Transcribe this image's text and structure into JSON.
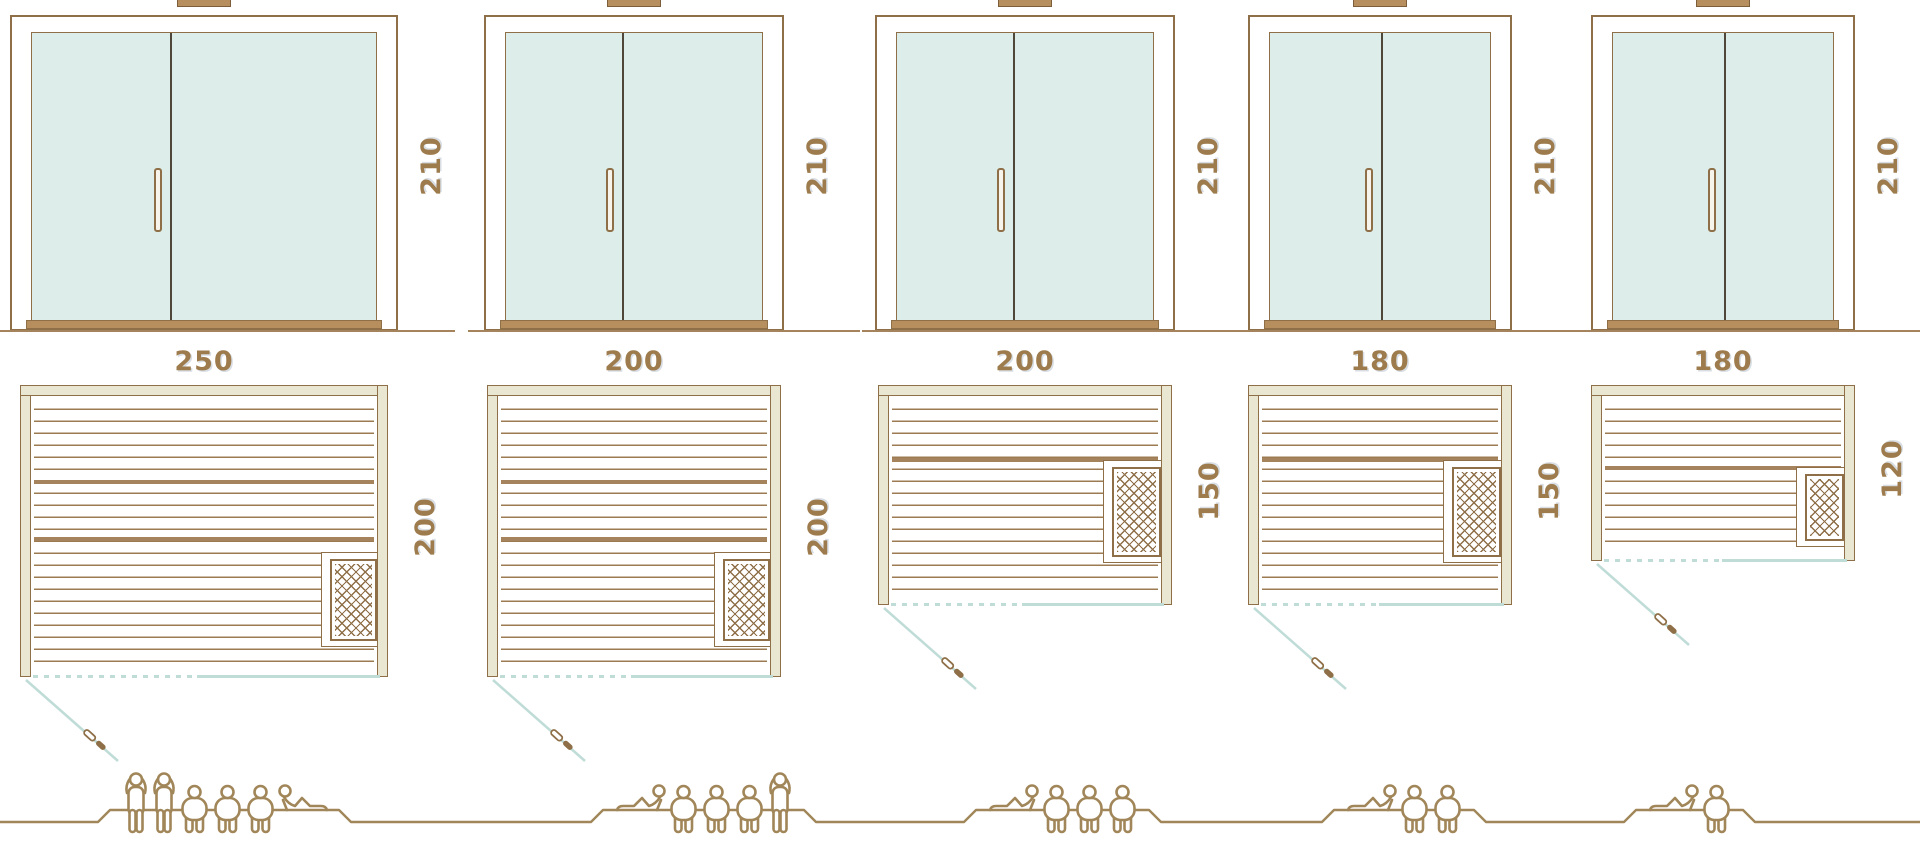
{
  "diagram": {
    "subject": "sauna size comparison",
    "views": [
      "door elevation",
      "floor plan",
      "capacity figures"
    ]
  },
  "columns": [
    {
      "door_height_label": "210",
      "width_label": "250",
      "depth_label": "200",
      "people": [
        "standing",
        "standing",
        "sitting",
        "sitting",
        "sitting",
        "lying"
      ]
    },
    {
      "door_height_label": "210",
      "width_label": "200",
      "depth_label": "200",
      "people": [
        "lying",
        "sitting",
        "sitting",
        "sitting",
        "standing"
      ]
    },
    {
      "door_height_label": "210",
      "width_label": "200",
      "depth_label": "150",
      "people": [
        "lying",
        "sitting",
        "sitting",
        "sitting"
      ]
    },
    {
      "door_height_label": "210",
      "width_label": "180",
      "depth_label": "150",
      "people": [
        "lying",
        "sitting",
        "sitting"
      ]
    },
    {
      "door_height_label": "210",
      "width_label": "180",
      "depth_label": "120",
      "people": [
        "lying",
        "sitting"
      ]
    }
  ],
  "icons": {
    "heater": "heater-icon",
    "door_swing": "door-swing-icon",
    "door_handle": "door-handle-icon",
    "people": [
      "person-standing-icon",
      "person-sitting-icon",
      "person-lying-icon"
    ]
  },
  "colors": {
    "line": "#8f6f47",
    "tan": "#b78f5f",
    "tan2": "#a5835c",
    "beige": "#e9e6d2",
    "glass": "#ddeeea",
    "teal": "#bfdcd7",
    "label": "#9d7b4c",
    "figure": "#a18659",
    "divider": "#4f483a",
    "slat": "#9d7b52"
  }
}
